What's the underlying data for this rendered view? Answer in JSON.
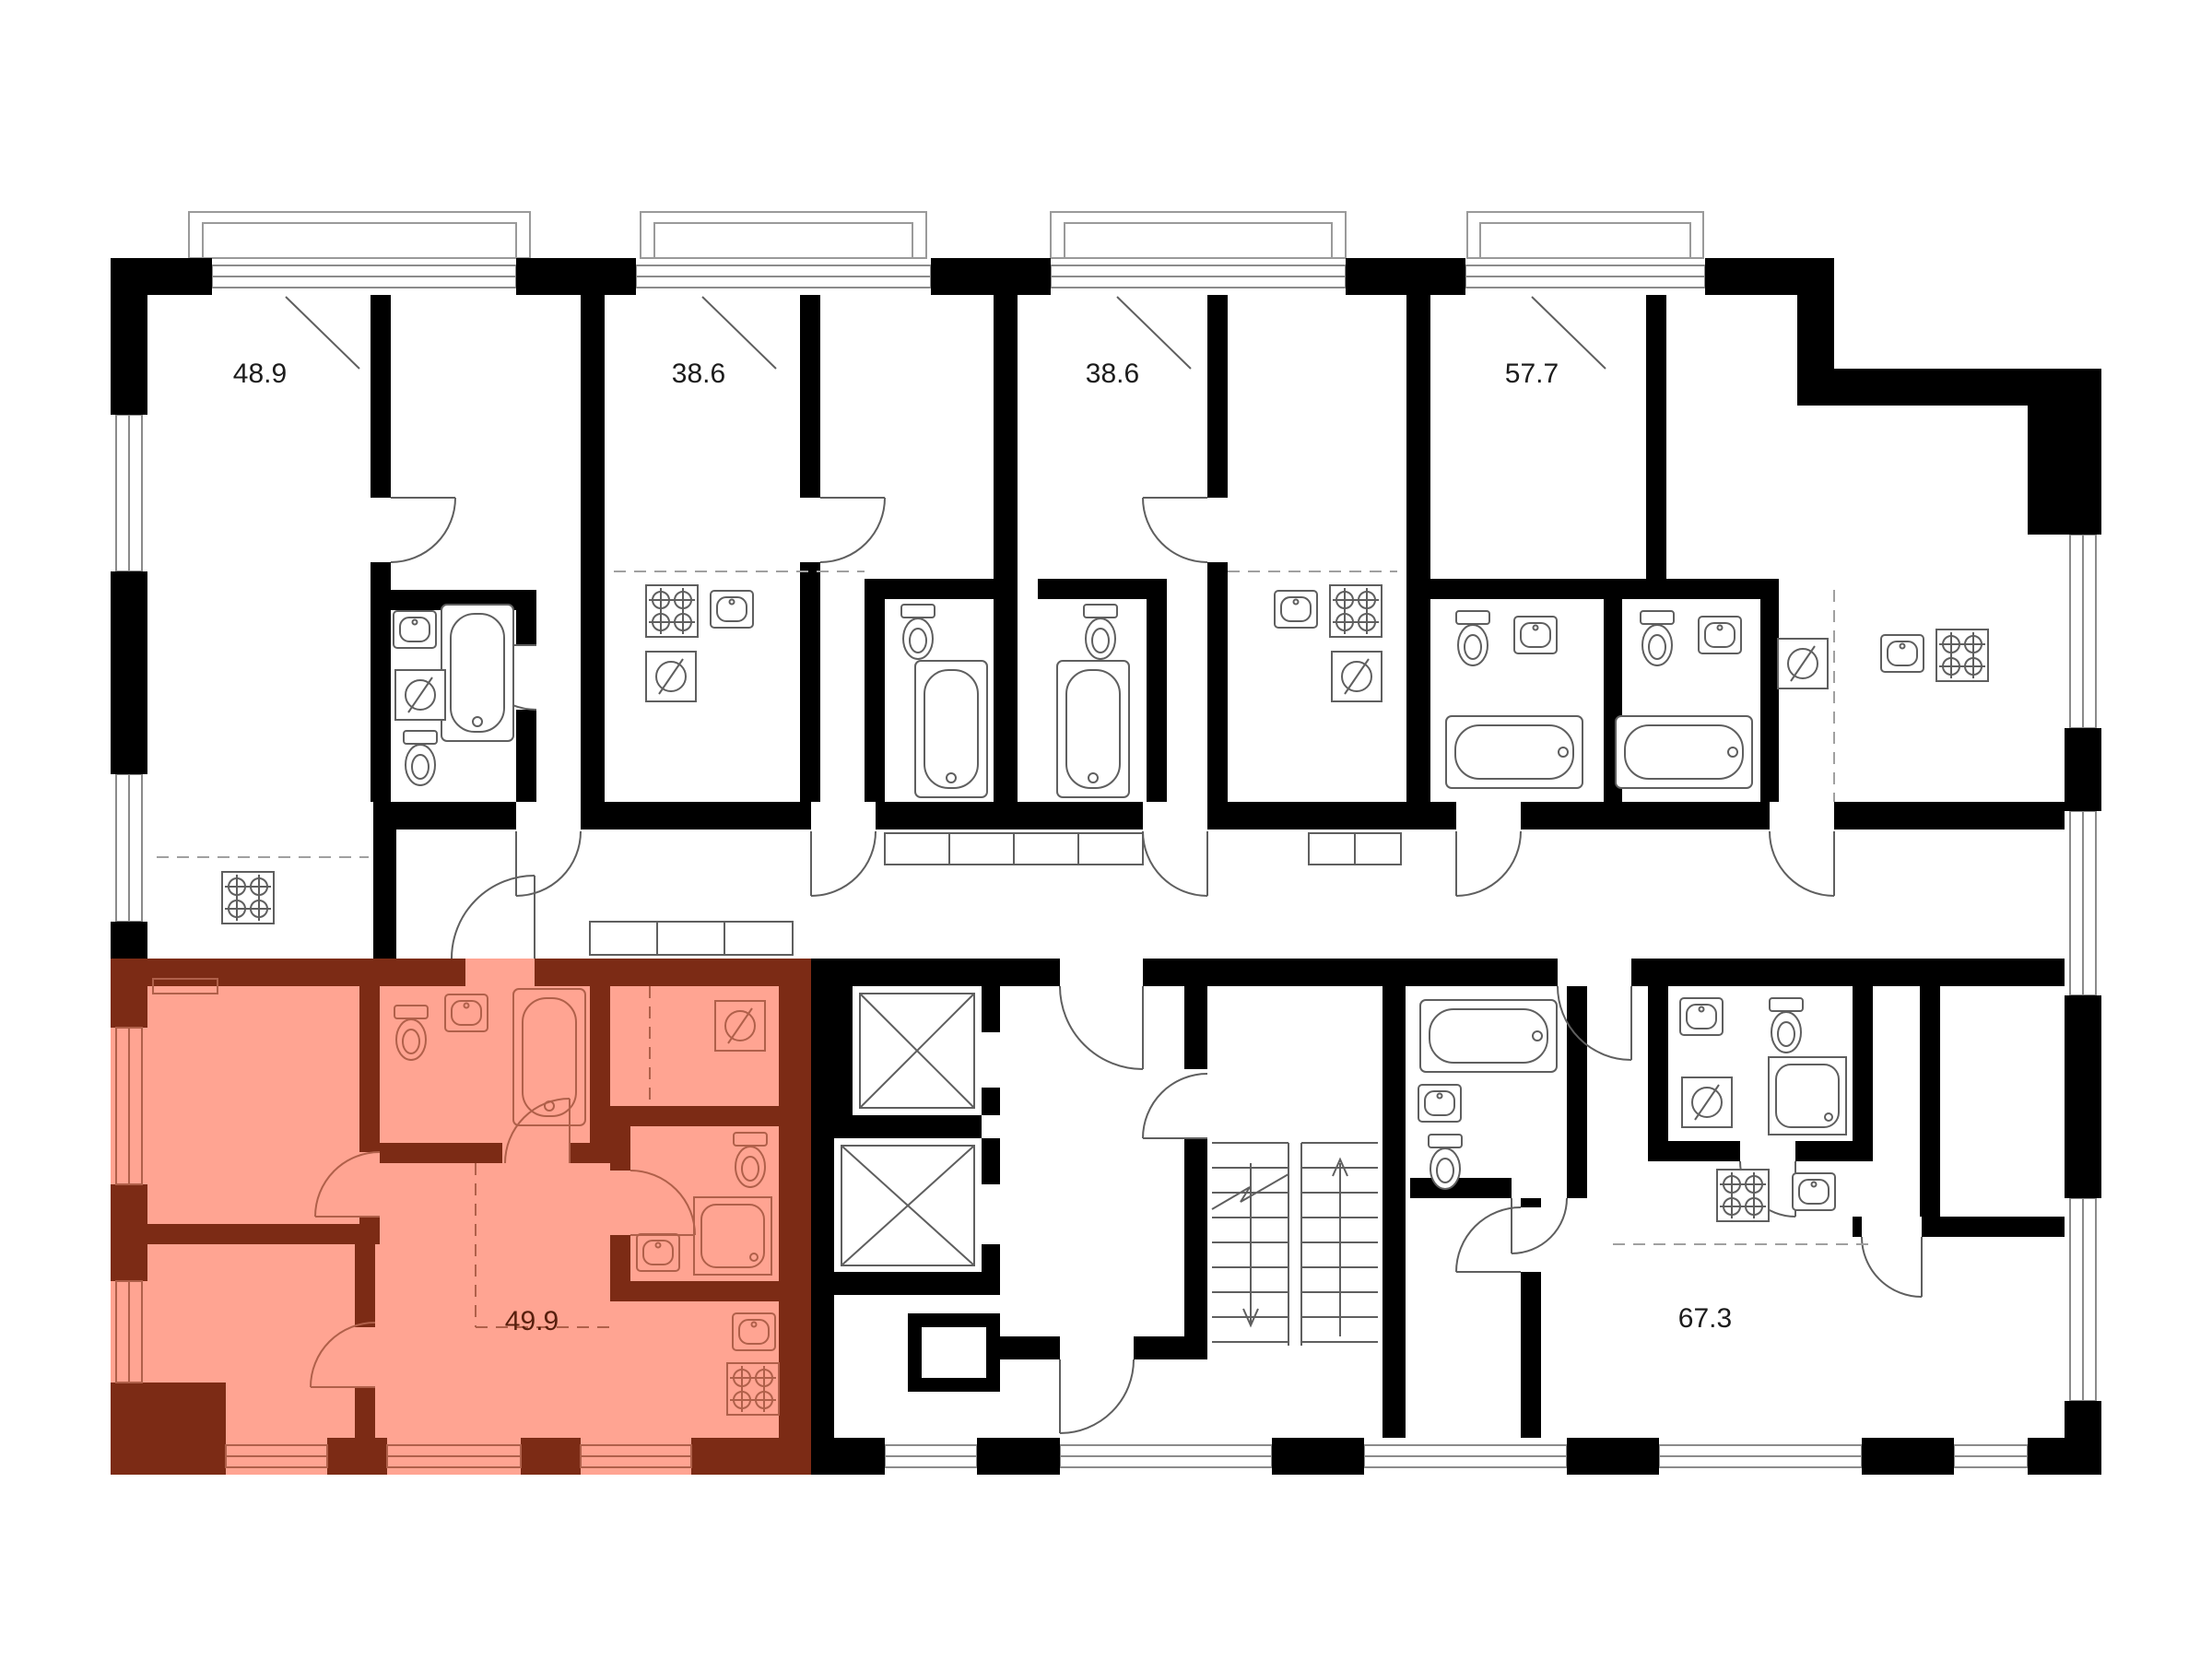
{
  "apartments": [
    {
      "id": "apt-top-1",
      "area_label": "48.9",
      "highlighted": false
    },
    {
      "id": "apt-top-2",
      "area_label": "38.6",
      "highlighted": false
    },
    {
      "id": "apt-top-3",
      "area_label": "38.6",
      "highlighted": false
    },
    {
      "id": "apt-top-4",
      "area_label": "57.7",
      "highlighted": false
    },
    {
      "id": "apt-bottom-left",
      "area_label": "49.9",
      "highlighted": true
    },
    {
      "id": "apt-bottom-right",
      "area_label": "67.3",
      "highlighted": false
    }
  ],
  "colors": {
    "background": "#ffffff",
    "walls": "#000000",
    "fixture_line": "#5f5f5f",
    "window_line": "#8b8b8b",
    "balcony_line": "#9a9a9a",
    "dashed_line": "#a0a0a0",
    "label": "#1c1c1c",
    "highlight_fill": "#ffa492",
    "highlight_wall": "#7c2b15",
    "highlight_line": "#b0604a",
    "highlight_label": "#571f0d"
  },
  "icons": [
    "bathtub-icon",
    "sink-icon",
    "toilet-icon",
    "stove-icon",
    "washing-machine-icon",
    "shower-icon",
    "elevator-icon",
    "stairs-icon",
    "door-arc-icon",
    "balcony-icon",
    "window-icon",
    "wardrobe-icon"
  ]
}
